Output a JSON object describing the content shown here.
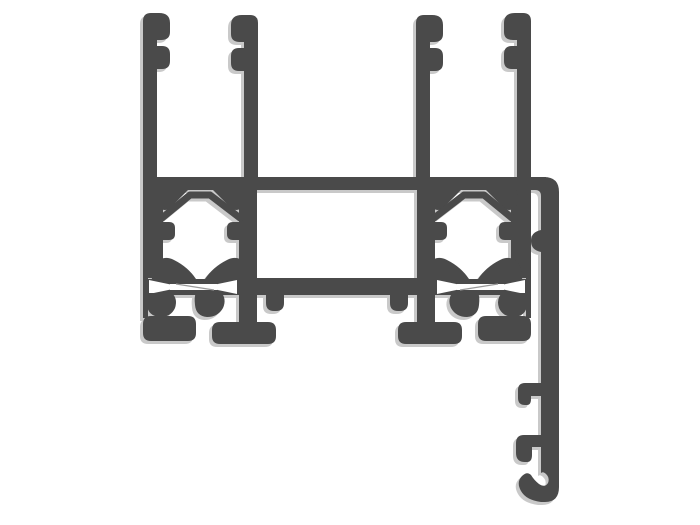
{
  "meta": {
    "description": "Black-and-white technical cross-section diagram of an aluminium window/door extrusion profile: two symmetric glazing-channel towers with serrated retention fins on top, internal screw-port chevron cavities, thermal-break bowtie slots, and mounting feet, joined by horizontal webs; a curved flange arm on the right side descends with two retention teeth and a J-hook at its end.",
    "diagram_type": "extrusion-profile-cross-section",
    "text_content_present": false
  },
  "canvas": {
    "width": 700,
    "height": 525,
    "background": "#ffffff"
  },
  "profile": {
    "fill": "#4a4a4a",
    "shadow": "#c9c9c9",
    "hairline": "#9a9a9a",
    "mirror_axis_x": 337,
    "paths": {
      "bar": "M143,177 L546,177 L546,190 L143,190 Z",
      "arm": "M531,177 L544,177 Q559,177 559,192 L559,487 Q559,502 545,502 L541,502 Q526,500 521,491 Q516,482 522,476 Q527,471 531,475 Q534,480 539,484 Q545,488 548,483 Q550,478 546,474 Q543,471 541,473 L541,252 Q531,250 531,241 Q531,232 541,230 L541,196 Q541,190 535,190 L531,190 Z",
      "tooth_upper": "M541,383 L525,383 Q518,383 518,390 L518,398 Q518,405 525,405 L527,405 Q531,405 531,399 L531,396 L541,396 Z",
      "tooth_lower": "M541,435 L524,435 Q516,435 516,443 L516,453 Q516,462 525,462 L527,462 Q532,462 532,455 L532,447 L541,447 Z",
      "fin_outer": "M143,190 L143,21 Q143,13 151,13 L159,13 Q170,13 170,23 L170,32 Q170,40 161,40 L157,40 L157,46 L162,46 Q170,46 170,54 L170,61 Q170,69 162,69 L157,69 L157,190 Z",
      "fin_inner": "M258,190 L258,23 Q258,15 250,15 L242,15 Q231,15 231,25 L231,34 Q231,42 240,42 L244,42 L244,48 L239,48 Q231,48 231,56 L231,63 Q231,71 239,71 L244,71 L244,190 Z",
      "wall_outer": "M143,188 L163,188 L163,278 L143,278 Z",
      "wall_strip": "M143,276 L148,276 L148,318 L143,318 Z",
      "wall_inner": "M239,188 L257,188 L257,322 L239,322 Z",
      "bump_outer": "M163,222 L169,222 Q175,222 175,228 L175,234 Q175,240 169,240 L163,240 Z",
      "bump_inner": "M239,222 L233,222 Q227,222 227,228 L227,234 Q227,240 233,240 L239,240 Z",
      "ear_outer": "M158,189 L189,189 L172,206 Q167,212 161,209 Q155,205 156,196 Z",
      "ear_inner": "M243,189 L212,189 L229,206 Q234,212 240,209 Q246,205 245,196 Z",
      "tent": "M162,218 L190,195 L210,195 L240,218",
      "hill_outer": "M152,281 Q151,268 157,262 Q164,255 174,260 Q188,267 196,279 L196,281 Z",
      "hill_inner": "M249,281 Q250,268 244,262 Q237,255 227,260 Q213,267 205,279 L205,281 Z",
      "bowtie_block": "M148,279 L239,279 L239,295 L148,295 Z",
      "flare_outer_white": "M149,280 L173,285 L173,289 L149,294 Z",
      "flare_inner_white": "M237,280 L213,285 L213,289 L237,294 Z",
      "slot_white": "M170,284 L217,284 L217,290 L170,290 Z",
      "slot_hairline": "M176,284 L214,290",
      "lobe_outer": "M147,293 L172,293 Q178,299 175,308 Q171,317 160,317 Q148,316 147,305 Z",
      "lobe_inner": "M196,292 L221,292 Q227,299 223,308 Q218,317 207,317 Q196,316 195,305 Q194,297 196,292 Z",
      "foot_outer": "M151,316 L188,316 Q196,316 196,324 L196,333 Q196,341 188,341 L151,341 Q143,341 143,333 L143,324 Q143,316 151,316 Z",
      "foot_inner": "M220,322 L268,322 Q276,322 276,330 L276,336 Q276,344 268,344 L220,344 Q212,344 212,336 L212,330 Q212,322 220,322 Z",
      "nub": "M266,293 L284,293 L284,303 Q284,311 276,311 L274,311 Q266,311 266,303 Z",
      "half_lower_bar": "M255,278 L340,278 L340,295 L255,295 Z"
    }
  }
}
